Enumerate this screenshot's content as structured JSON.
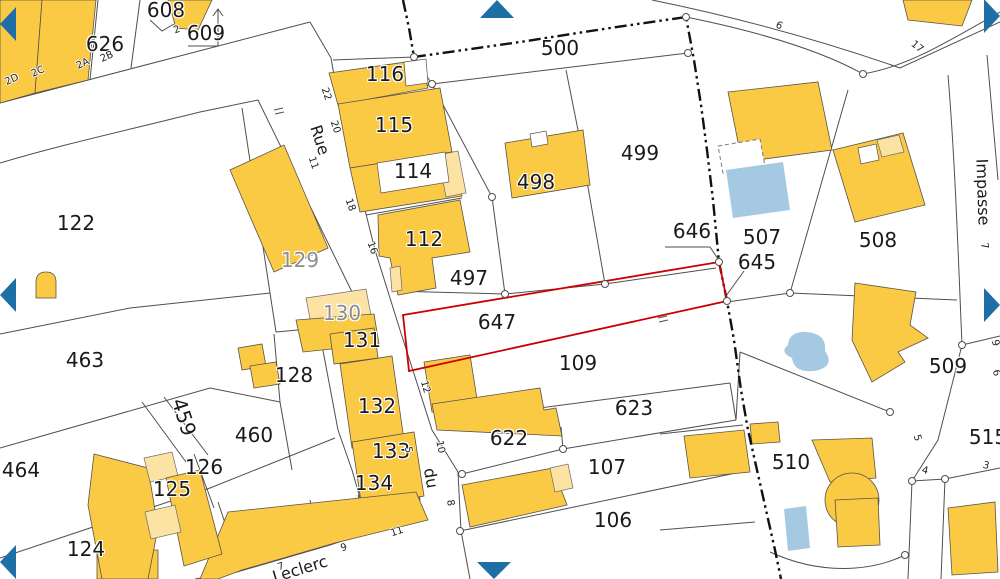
{
  "map": {
    "type": "cadastral-map",
    "selected_parcel": "647",
    "colors": {
      "building": "#FBCA45",
      "building_light": "#FCE3A4",
      "water": "#A6C9E3",
      "selected": "#CC0000",
      "boundary": "#111111",
      "parcel_line": "#4F4F4F",
      "marker": "#1D6FA5",
      "label": "#1A1A1A",
      "label_gray": "#8C8C8C"
    },
    "parcel_labels": [
      {
        "t": "626",
        "x": 105,
        "y": 44
      },
      {
        "t": "608",
        "x": 166,
        "y": 10
      },
      {
        "t": "609",
        "x": 206,
        "y": 33
      },
      {
        "t": "116",
        "x": 385,
        "y": 74
      },
      {
        "t": "115",
        "x": 394,
        "y": 125
      },
      {
        "t": "114",
        "x": 413,
        "y": 171
      },
      {
        "t": "112",
        "x": 424,
        "y": 239
      },
      {
        "t": "122",
        "x": 76,
        "y": 223
      },
      {
        "t": "129",
        "x": 300,
        "y": 260,
        "muted": true
      },
      {
        "t": "463",
        "x": 85,
        "y": 360
      },
      {
        "t": "130",
        "x": 342,
        "y": 313,
        "muted": true
      },
      {
        "t": "131",
        "x": 362,
        "y": 340
      },
      {
        "t": "128",
        "x": 294,
        "y": 375
      },
      {
        "t": "132",
        "x": 377,
        "y": 406
      },
      {
        "t": "133",
        "x": 391,
        "y": 451
      },
      {
        "t": "134",
        "x": 374,
        "y": 483
      },
      {
        "t": "459",
        "x": 184,
        "y": 417,
        "rot": 72
      },
      {
        "t": "460",
        "x": 254,
        "y": 435
      },
      {
        "t": "126",
        "x": 204,
        "y": 467
      },
      {
        "t": "125",
        "x": 172,
        "y": 489
      },
      {
        "t": "464",
        "x": 21,
        "y": 470
      },
      {
        "t": "124",
        "x": 86,
        "y": 549
      },
      {
        "t": "497",
        "x": 469,
        "y": 278
      },
      {
        "t": "498",
        "x": 536,
        "y": 182
      },
      {
        "t": "499",
        "x": 640,
        "y": 153
      },
      {
        "t": "500",
        "x": 560,
        "y": 48
      },
      {
        "t": "646",
        "x": 692,
        "y": 231
      },
      {
        "t": "507",
        "x": 762,
        "y": 237
      },
      {
        "t": "645",
        "x": 757,
        "y": 262
      },
      {
        "t": "508",
        "x": 878,
        "y": 240
      },
      {
        "t": "509",
        "x": 948,
        "y": 366
      },
      {
        "t": "515",
        "x": 988,
        "y": 437
      },
      {
        "t": "510",
        "x": 791,
        "y": 462
      },
      {
        "t": "647",
        "x": 497,
        "y": 322
      },
      {
        "t": "109",
        "x": 578,
        "y": 363
      },
      {
        "t": "623",
        "x": 634,
        "y": 408
      },
      {
        "t": "622",
        "x": 509,
        "y": 438
      },
      {
        "t": "107",
        "x": 607,
        "y": 467
      },
      {
        "t": "106",
        "x": 613,
        "y": 520
      }
    ],
    "street_labels": [
      {
        "t": "Rue",
        "x": 320,
        "y": 140,
        "rot": 72
      },
      {
        "t": "du",
        "x": 431,
        "y": 478,
        "rot": 80
      },
      {
        "t": "Leclerc",
        "x": 300,
        "y": 569,
        "rot": -17
      },
      {
        "t": "Impasse",
        "x": 983,
        "y": 192,
        "rot": 88
      }
    ],
    "address_numbers": [
      {
        "t": "2D",
        "x": 12,
        "y": 80,
        "rot": -24
      },
      {
        "t": "2C",
        "x": 38,
        "y": 72,
        "rot": -24
      },
      {
        "t": "2A",
        "x": 83,
        "y": 64,
        "rot": -24
      },
      {
        "t": "2B",
        "x": 107,
        "y": 57,
        "rot": -24
      },
      {
        "t": "2",
        "x": 177,
        "y": 30,
        "rot": -20
      },
      {
        "t": "22",
        "x": 326,
        "y": 94,
        "rot": 72
      },
      {
        "t": "20",
        "x": 335,
        "y": 127,
        "rot": 72
      },
      {
        "t": "11",
        "x": 313,
        "y": 163,
        "rot": 72
      },
      {
        "t": "18",
        "x": 350,
        "y": 205,
        "rot": 70
      },
      {
        "t": "16",
        "x": 372,
        "y": 248,
        "rot": 70
      },
      {
        "t": "12",
        "x": 425,
        "y": 387,
        "rot": 74
      },
      {
        "t": "10",
        "x": 440,
        "y": 447,
        "rot": 78
      },
      {
        "t": "5",
        "x": 408,
        "y": 450,
        "rot": 78
      },
      {
        "t": "8",
        "x": 450,
        "y": 503,
        "rot": 80
      },
      {
        "t": "11",
        "x": 397,
        "y": 532,
        "rot": -18
      },
      {
        "t": "9",
        "x": 344,
        "y": 548,
        "rot": -18
      },
      {
        "t": "7",
        "x": 281,
        "y": 567,
        "rot": -18
      },
      {
        "t": "6",
        "x": 779,
        "y": 26,
        "rot": 26
      },
      {
        "t": "17",
        "x": 917,
        "y": 47,
        "rot": 40
      },
      {
        "t": "7",
        "x": 984,
        "y": 246,
        "rot": 80
      },
      {
        "t": "9",
        "x": 995,
        "y": 343,
        "rot": 76
      },
      {
        "t": "6",
        "x": 996,
        "y": 373,
        "rot": 76
      },
      {
        "t": "5",
        "x": 917,
        "y": 438,
        "rot": 72
      },
      {
        "t": "4",
        "x": 925,
        "y": 471,
        "rot": 14
      },
      {
        "t": "3",
        "x": 986,
        "y": 466,
        "rot": 14
      }
    ],
    "edge_markers": [
      {
        "dir": "left",
        "x": 0,
        "y": 24
      },
      {
        "dir": "up",
        "x": 497,
        "y": 0
      },
      {
        "dir": "right",
        "x": 1000,
        "y": 16
      },
      {
        "dir": "left",
        "x": 0,
        "y": 295
      },
      {
        "dir": "right",
        "x": 1000,
        "y": 305
      },
      {
        "dir": "left",
        "x": 0,
        "y": 562
      },
      {
        "dir": "down",
        "x": 494,
        "y": 579
      }
    ]
  }
}
